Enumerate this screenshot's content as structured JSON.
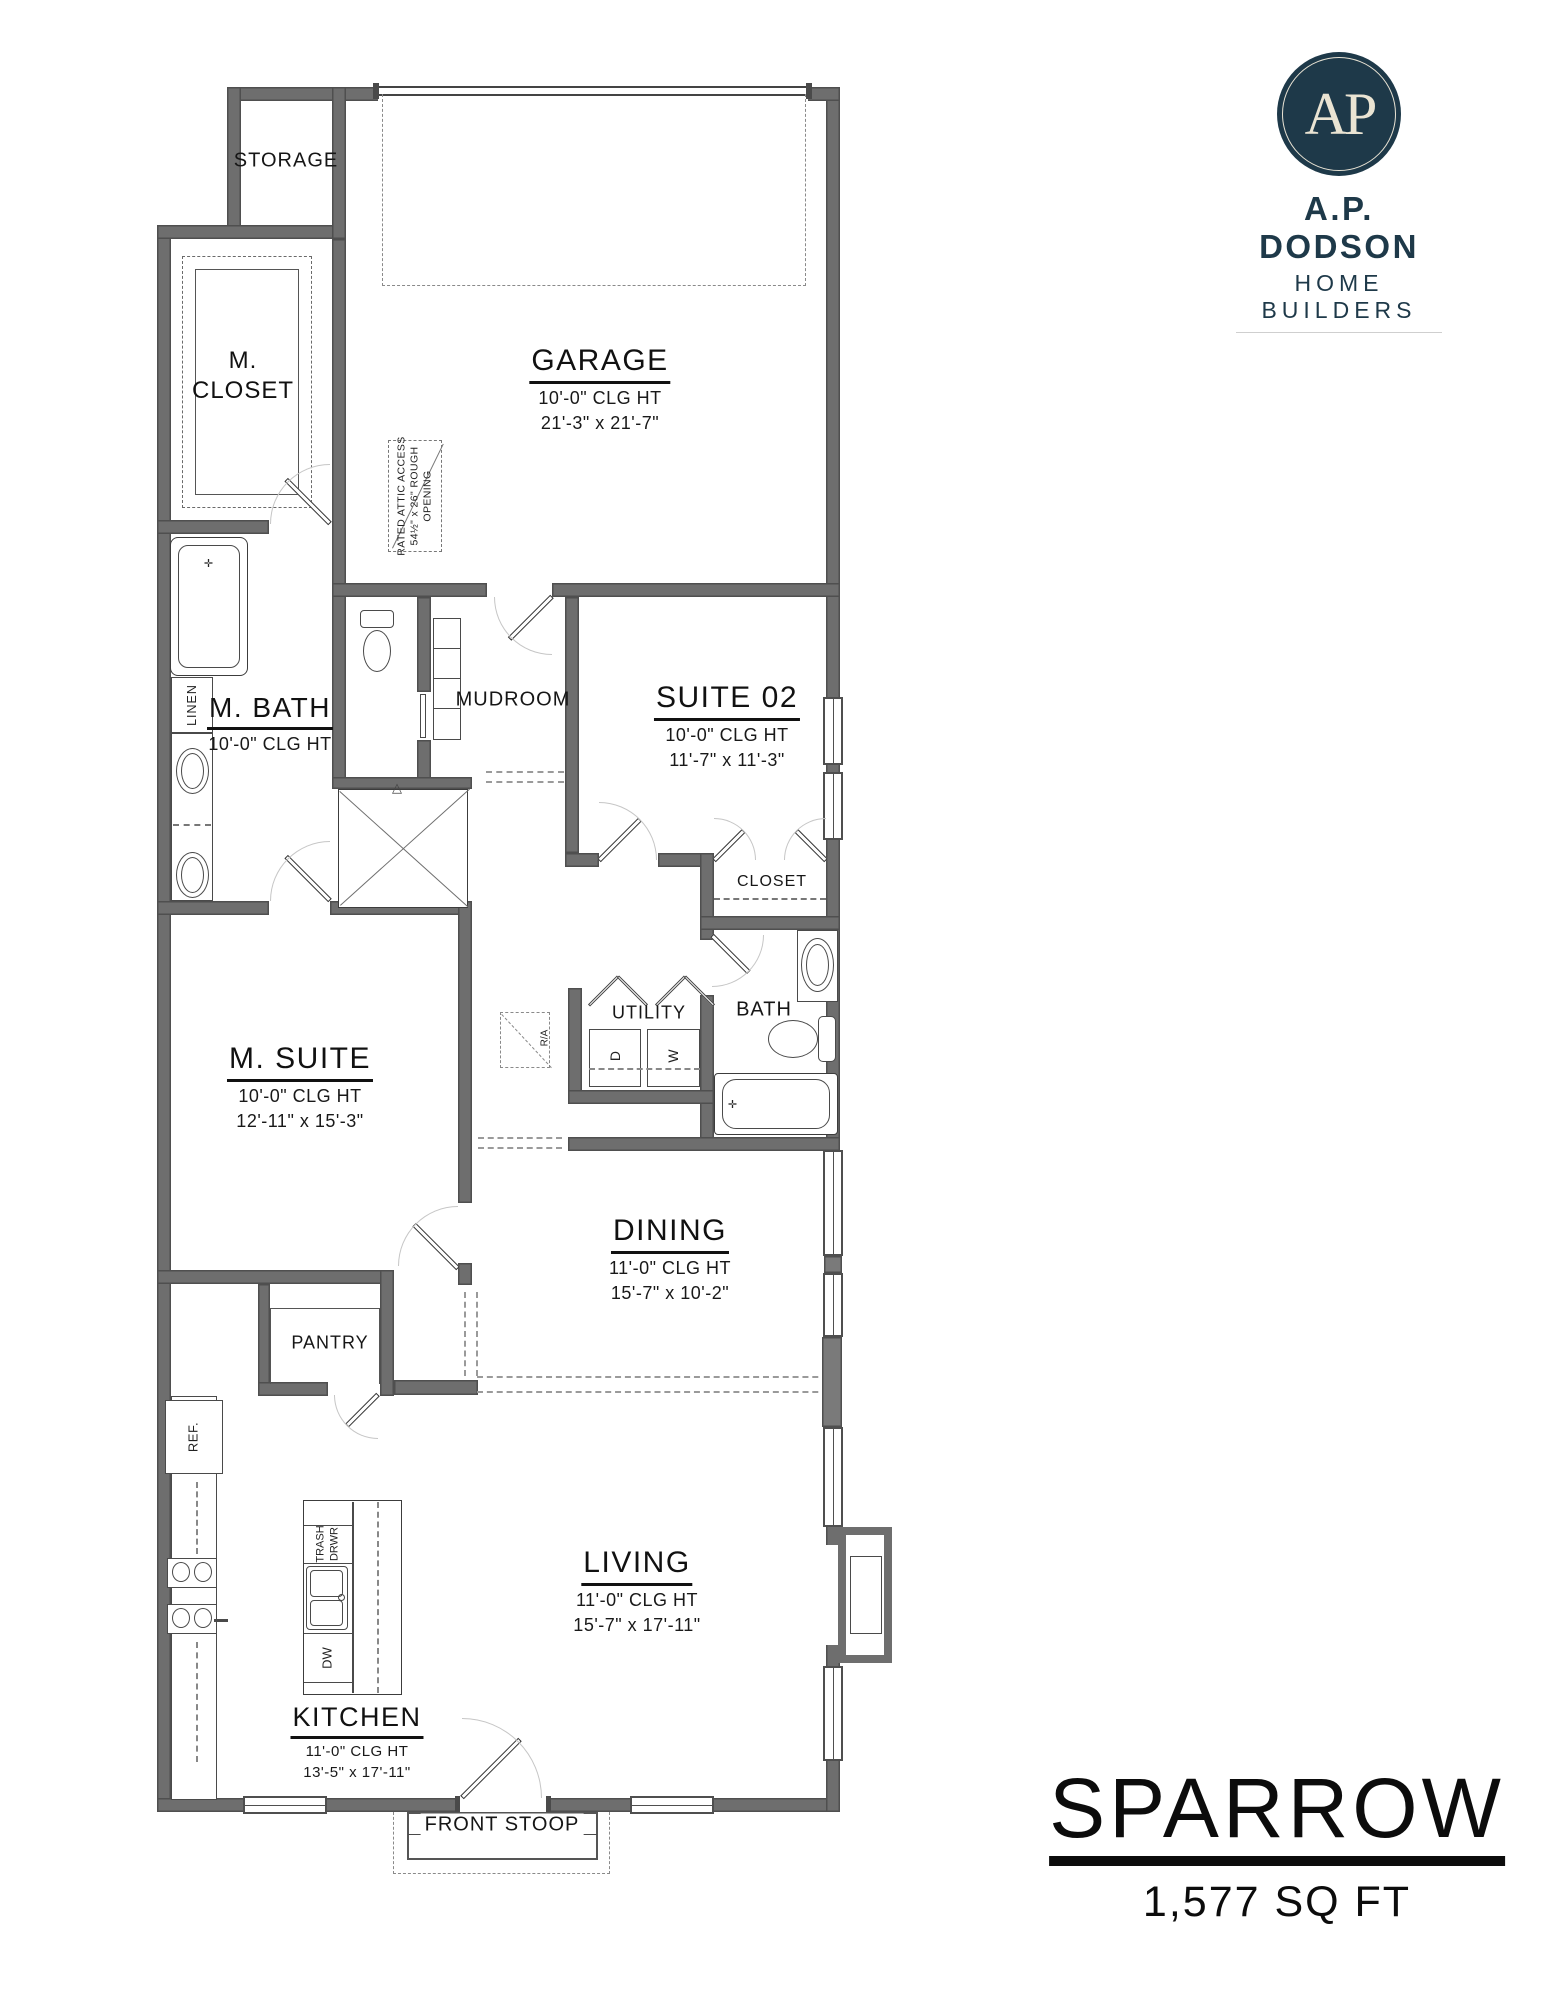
{
  "plan": {
    "name": "SPARROW",
    "area": "1,577 SQ FT"
  },
  "branding": {
    "monogram": "AP",
    "company": "A.P. DODSON",
    "tagline": "HOME BUILDERS",
    "navy": "#1e3949",
    "cream": "#eae4d3"
  },
  "rooms": {
    "garage": {
      "name": "GARAGE",
      "ceiling": "10'-0\" CLG HT",
      "dimensions": "21'-3\" x 21'-7\""
    },
    "suite02": {
      "name": "SUITE 02",
      "ceiling": "10'-0\" CLG HT",
      "dimensions": "11'-7\" x 11'-3\""
    },
    "m_bath": {
      "name": "M. BATH",
      "ceiling": "10'-0\" CLG HT"
    },
    "m_suite": {
      "name": "M. SUITE",
      "ceiling": "10'-0\" CLG HT",
      "dimensions": "12'-11\" x 15'-3\""
    },
    "dining": {
      "name": "DINING",
      "ceiling": "11'-0\" CLG HT",
      "dimensions": "15'-7\" x 10'-2\""
    },
    "living": {
      "name": "LIVING",
      "ceiling": "11'-0\" CLG HT",
      "dimensions": "15'-7\" x 17'-11\""
    },
    "kitchen": {
      "name": "KITCHEN",
      "ceiling": "11'-0\" CLG HT",
      "dimensions": "13'-5\" x 17'-11\""
    },
    "m_closet": {
      "line1": "M.",
      "line2": "CLOSET"
    }
  },
  "labels": {
    "storage": "STORAGE",
    "mudroom": "MUDROOM",
    "closet": "CLOSET",
    "utility": "UTILITY",
    "bath": "BATH",
    "pantry": "PANTRY",
    "front_stoop": "FRONT STOOP",
    "linen": "LINEN",
    "ref": "REF.",
    "dw": "DW",
    "trash1": "TRASH",
    "trash2": "DRWR",
    "dryer": "D",
    "washer": "W",
    "return_air": "R/A"
  },
  "annotations": {
    "attic1": "RATED ATTIC ACCESS",
    "attic2": "54½\" x 26\" ROUGH",
    "attic3": "OPENING"
  }
}
